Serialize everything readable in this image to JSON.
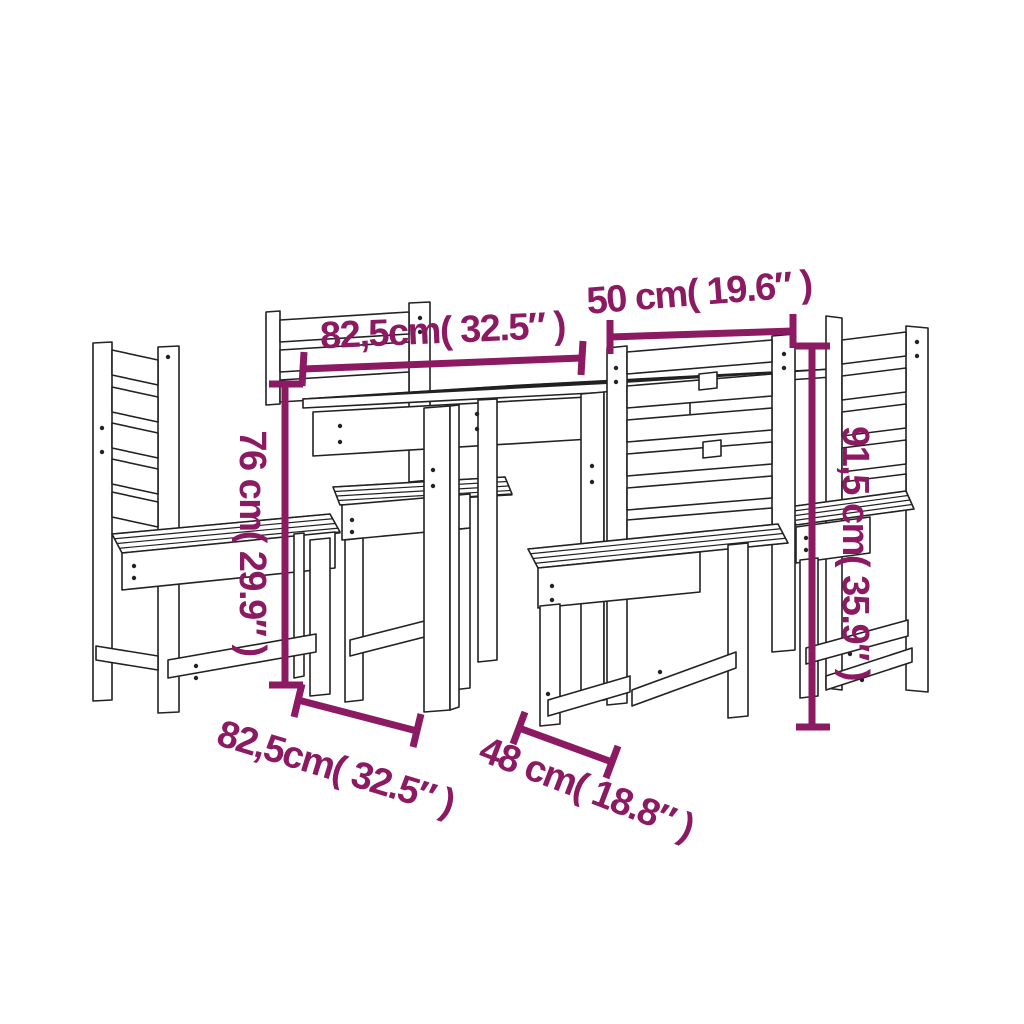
{
  "colors": {
    "background": "#ffffff",
    "dimension_accent": "#8B1A62",
    "line_art": "#222222"
  },
  "figure": {
    "description": "Line drawing of a wooden garden dining set: square slatted table with four slat-back chairs",
    "pieces": [
      "chair-left",
      "chair-back",
      "table",
      "chair-front-right",
      "chair-right"
    ]
  },
  "dimensions": {
    "tabletop_width": {
      "label": "82,5cm( 32.5″ )",
      "orientation": "horizontal-top"
    },
    "chair_back_width": {
      "label": "50 cm( 19.6″ )",
      "orientation": "horizontal-top"
    },
    "table_height": {
      "label": "76 cm( 29.9″ )",
      "orientation": "vertical-left"
    },
    "chair_height": {
      "label": "91,5 cm( 35.9″ )",
      "orientation": "vertical-right"
    },
    "tabletop_depth": {
      "label": "82,5cm( 32.5″ )",
      "orientation": "diagonal-bottom-left"
    },
    "chair_seat_width": {
      "label": "48 cm( 18.8″ )",
      "orientation": "diagonal-bottom-center"
    }
  }
}
